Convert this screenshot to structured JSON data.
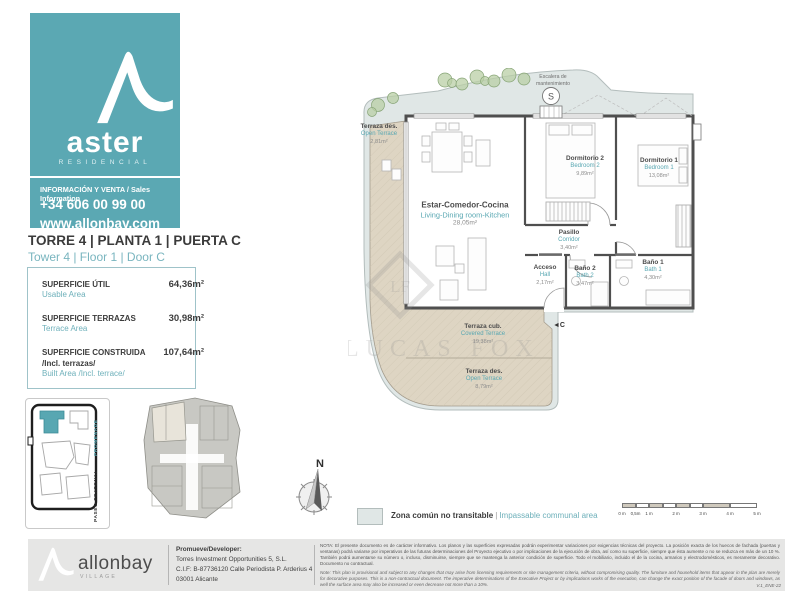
{
  "brand": {
    "name": "aster",
    "sub": "RESIDENCIAL",
    "info_label": "INFORMACIÓN Y VENTA / Sales Information",
    "phone": "+34 606 00 99 00",
    "website": "www.allonbay.com"
  },
  "unit": {
    "title_es": "TORRE 4 | PLANTA 1 | PUERTA C",
    "title_en": "Tower 4 | Floor 1 | Door C"
  },
  "areas": [
    {
      "label_es": "SUPERFICIE ÚTIL",
      "label_en": "Usable Area",
      "value": "64,36m²"
    },
    {
      "label_es": "SUPERFICIE TERRAZAS",
      "label_en": "Terrace Area",
      "value": "30,98m²"
    },
    {
      "label_es": "SUPERFICIE CONSTRUIDA",
      "label_es2": "/Incl. terrazas/",
      "label_en": "Built Area /Incl. terrace/",
      "value": "107,64m²"
    }
  ],
  "plan": {
    "stair_label_1": "Escalera de",
    "stair_label_2": "mantenimiento",
    "stair_symbol": "S",
    "door_marker": "◄C",
    "rooms": [
      {
        "name_es": "Terraza des.",
        "name_en": "Open Terrace",
        "area": "2,81m²"
      },
      {
        "name_es": "Estar-Comedor-Cocina",
        "name_en": "Living-Dining room-Kitchen",
        "area": "28,05m²"
      },
      {
        "name_es": "Dormitorio 2",
        "name_en": "Bedroom 2",
        "area": "9,89m²"
      },
      {
        "name_es": "Dormitorio 1",
        "name_en": "Bedroom 1",
        "area": "13,08m²"
      },
      {
        "name_es": "Pasillo",
        "name_en": "Corridor",
        "area": "3,40m²"
      },
      {
        "name_es": "Acceso",
        "name_en": "Hall",
        "area": "2,17m²"
      },
      {
        "name_es": "Baño 2",
        "name_en": "Bath 2",
        "area": "3,47m²"
      },
      {
        "name_es": "Baño 1",
        "name_en": "Bath 1",
        "area": "4,30m²"
      },
      {
        "name_es": "Terraza cub.",
        "name_en": "Covered Terrace",
        "area": "19,38m²"
      },
      {
        "name_es": "Terraza des.",
        "name_en": "Open Terrace",
        "area": "8,79m²"
      }
    ]
  },
  "site_map": {
    "label_promenade": "PROMENADE",
    "label_paseo": "PASEO PEATONAL"
  },
  "compass": {
    "north_label": "N"
  },
  "legend": {
    "label_es": "Zona común no transitable",
    "separator": "|",
    "label_en": "Impassable communal area"
  },
  "scale_bar": {
    "labels": [
      "0 m",
      "0,5m",
      "1 m",
      "2 m",
      "3 m",
      "4 m",
      "5 m"
    ]
  },
  "watermark": {
    "initials": "LF",
    "text": "LUCAS FOX"
  },
  "footer": {
    "logo_name": "allonbay",
    "logo_sub": "VILLAGE",
    "developer_title": "Promueve/Developer:",
    "developer_line1": "Torres Investment Opportunities 5, S.L.",
    "developer_line2": "C.I.F: B-87736120 Calle Periodista P. Arderius 4",
    "developer_line3": "03001 Alicante",
    "note_es": "NOTA: El presente documento es de carácter informativo. Los planos y las superficies expresadas podrán experimentar variaciones por exigencias técnicas del proyecto. La posición exacta de los huecos de fachada (puertas y ventanas) podrá variarse por imperativos de las futuras determinaciones del Proyecto ejecutivo o por implicaciones de la ejecución de obra, así como su superficie, siempre que ésta aumente o no se reduzca en más de un 10 %. También podrá aumentarse su número o, incluso, disminuirse, siempre que se mantenga la anterior condición de superficie. Todo el mobiliario, incluido el de la cocina, armarios y electrodomésticos, es meramente decorativo. Documento no contractual.",
    "note_en": "Note: This plan is provisional and subject to any changes that may arise from licensing requirements or site management criteria, without compromising quality. The furniture and household items that appear in the plan are merely for decorative purposes. This is a non-contractual document. The imperative determinations of the Executive Project or by implications works of the execution, can change the exact position of the facade of doors and windows, as well the surface area may also be increased or even decrease not more than a 10%.",
    "version": "V.1_ENE-22"
  },
  "colors": {
    "teal": "#5ba8b3",
    "teal_text": "#58a7b2",
    "communal_zone": "#e0e7e6",
    "terrace": "#ded5c3",
    "wall": "#4f4f4f",
    "footer_bg": "#e6e6e5"
  }
}
